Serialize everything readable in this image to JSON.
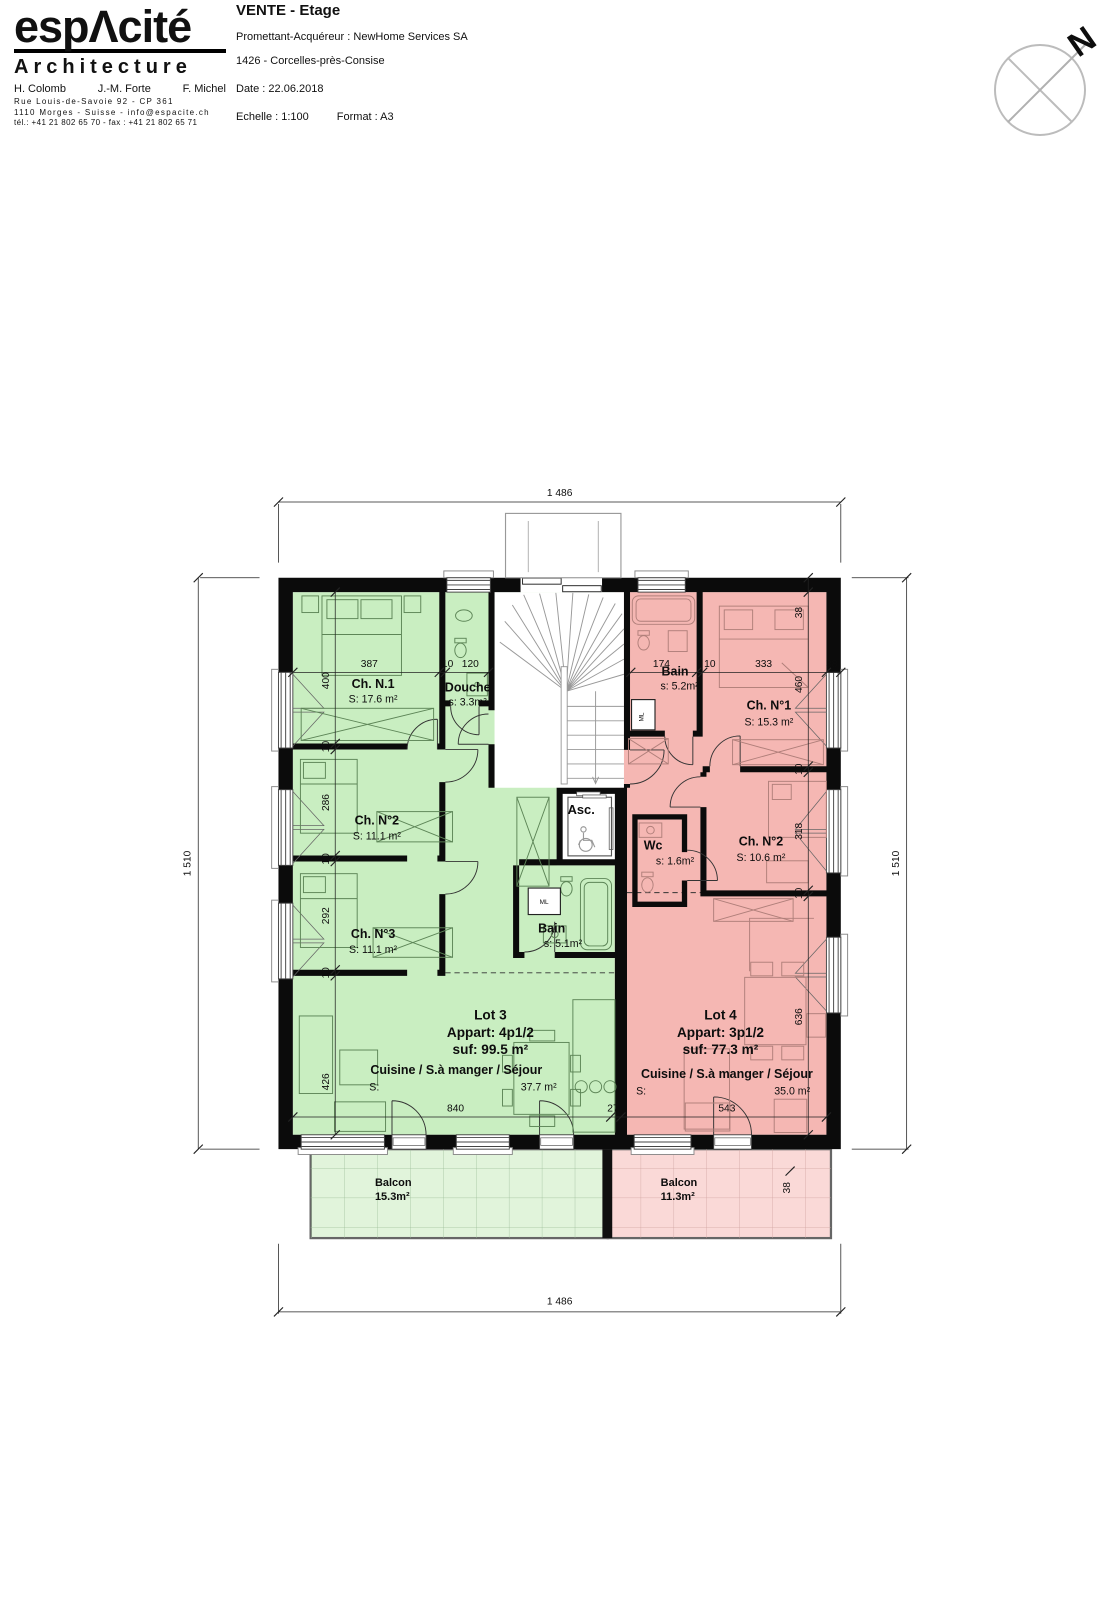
{
  "header": {
    "logo": {
      "name": "espΛcité",
      "sub": "Architecture",
      "partner1": "H. Colomb",
      "partner2": "J.-M. Forte",
      "partner3": "F. Michel",
      "address1": "Rue Louis-de-Savoie 92 - CP 361",
      "address2": "1110 Morges - Suisse - info@espacite.ch",
      "phone": "tél.: +41 21 802 65 70  -  fax : +41 21 802 65 71"
    },
    "title": "VENTE - Etage",
    "client": "Promettant-Acquéreur : NewHome Services SA",
    "location": "1426 - Corcelles-près-Consise",
    "date": "Date : 22.06.2018",
    "scale": "Echelle : 1:100",
    "format": "Format : A3",
    "north": "N"
  },
  "plan": {
    "lot3": {
      "ch1": {
        "name": "Ch. N.1",
        "area": "S: 17.6 m²"
      },
      "douche": {
        "name": "Douche",
        "area": "s: 3.3m²"
      },
      "ch2": {
        "name": "Ch. N°2",
        "area": "S: 11.1 m²"
      },
      "ch3": {
        "name": "Ch. N°3",
        "area": "S: 11.1 m²"
      },
      "bain": {
        "name": "Bain",
        "area": "s: 5.1m²"
      },
      "lot": {
        "l1": "Lot 3",
        "l2": "Appart: 4p1/2",
        "l3": "suf: 99.5 m²"
      },
      "cuisine": {
        "name": "Cuisine / S.à manger / Séjour",
        "s": "S:",
        "area": "37.7 m²"
      },
      "balcon": {
        "name": "Balcon",
        "area": "15.3m²"
      }
    },
    "lot4": {
      "bain": {
        "name": "Bain",
        "area": "s: 5.2m²"
      },
      "ch1": {
        "name": "Ch. N°1",
        "area": "S: 15.3 m²"
      },
      "wc": {
        "name": "Wc",
        "area": "s: 1.6m²"
      },
      "ch2": {
        "name": "Ch. N°2",
        "area": "S: 10.6 m²"
      },
      "lot": {
        "l1": "Lot 4",
        "l2": "Appart: 3p1/2",
        "l3": "suf: 77.3 m²"
      },
      "cuisine": {
        "name": "Cuisine / S.à manger / Séjour",
        "s": "S:",
        "area": "35.0 m²"
      },
      "balcon": {
        "name": "Balcon",
        "area": "11.3m²"
      }
    },
    "common": {
      "asc": "Asc.",
      "ml": "ML"
    },
    "dims": {
      "overall_w": "1 486",
      "overall_h": "1 510",
      "g_top": [
        "387",
        "10",
        "120"
      ],
      "p_top": [
        "174",
        "10",
        "333",
        "38"
      ],
      "g_left": [
        "400",
        "10",
        "286",
        "10",
        "292",
        "10",
        "426"
      ],
      "p_right": [
        "38",
        "460",
        "10",
        "318",
        "10",
        "636"
      ],
      "g_bottom": [
        "840",
        "27"
      ],
      "p_bottom": "543",
      "balcony_wall": "38"
    },
    "colors": {
      "lot3": "#c9eec1",
      "lot4": "#f5b7b3",
      "balcon3": "#e1f4db",
      "balcon4": "#fad9d7"
    }
  }
}
